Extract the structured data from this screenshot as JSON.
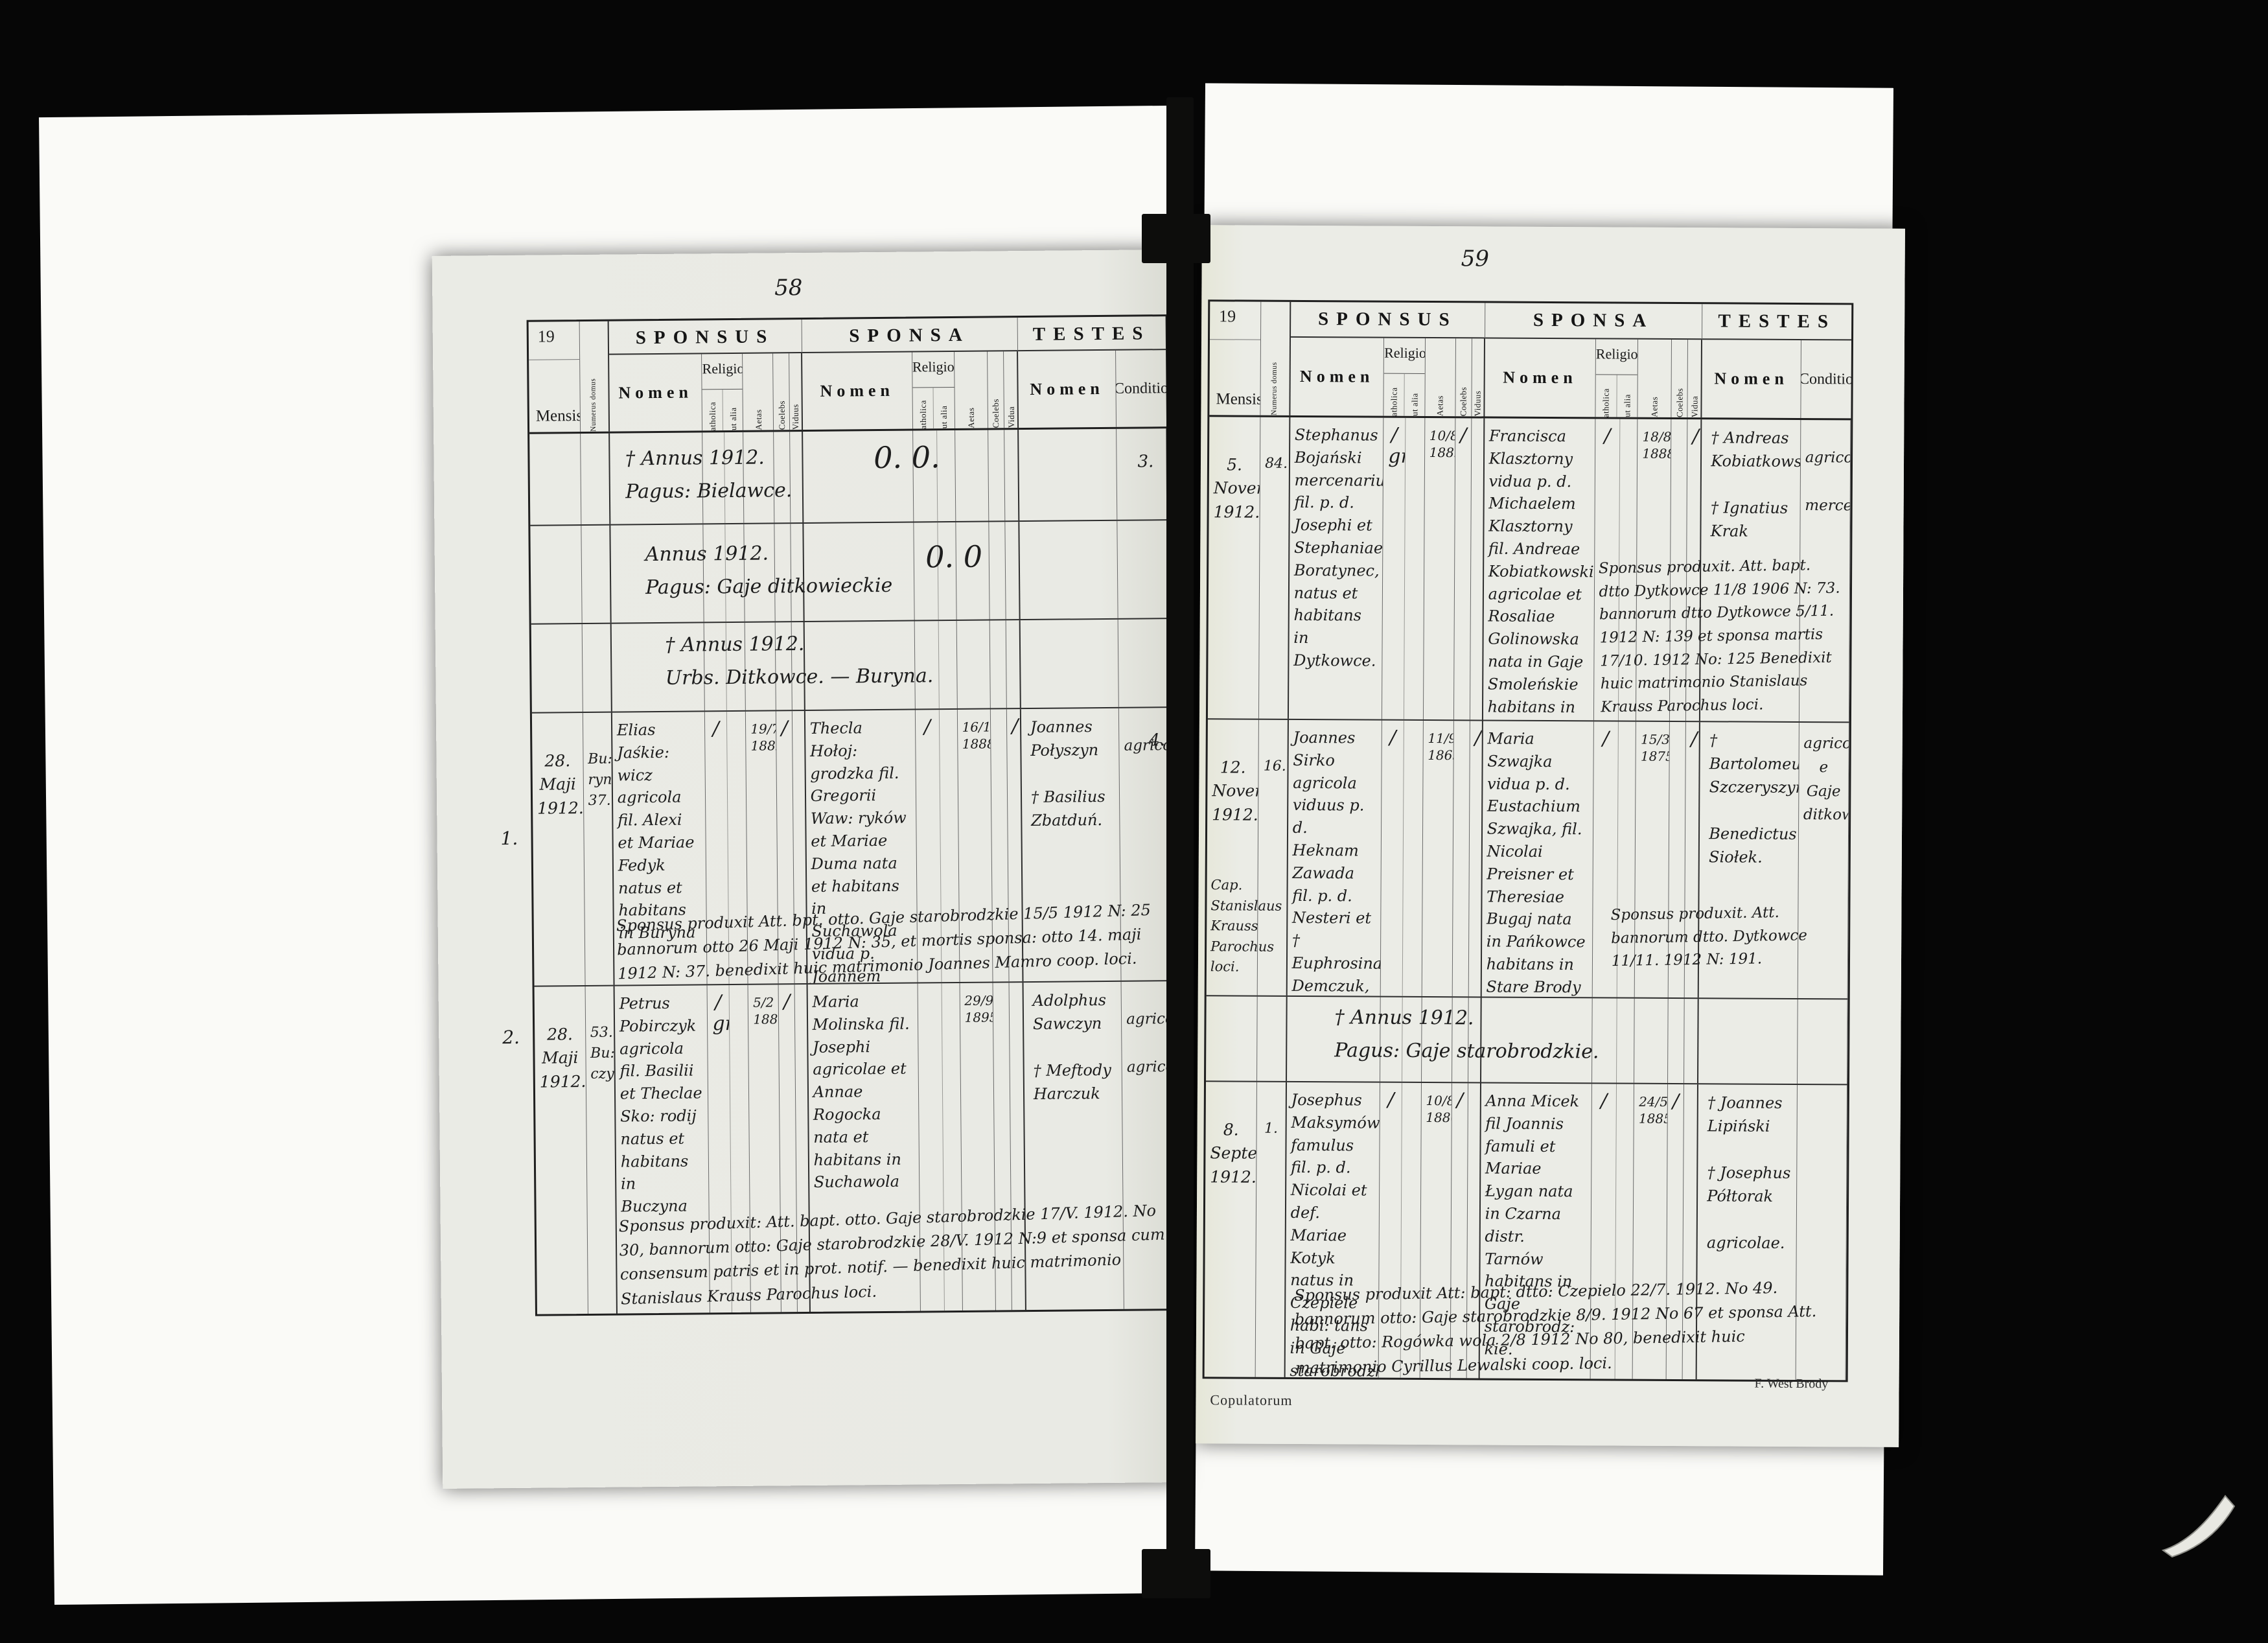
{
  "header": {
    "year_printed": "19",
    "mensis": "Mensis",
    "numerus_domus": "Numerus domus",
    "sponsus": "SPONSUS",
    "sponsa": "SPONSA",
    "testes": "TESTES",
    "nomen": "Nomen",
    "religio": "Religio",
    "catholica": "Catholica",
    "aut_alia": "Aut alia",
    "aetas": "Aetas",
    "coelebs": "Coelebs",
    "viduus": "Viduus",
    "vidua": "Vidua",
    "conditio": "Conditio"
  },
  "left_page": {
    "page_number": "58",
    "margin_marks": {
      "m1": "3.",
      "m2": "4."
    },
    "sections": [
      {
        "text": "† Annus 1912.\nPagus: Bielawce.",
        "mark": "0. 0."
      },
      {
        "text": "Annus 1912.\nPagus: Gaje ditkowieckie",
        "mark": "0. 0"
      },
      {
        "text": "† Annus 1912.\nUrbs. Ditkowce. — Buryna.",
        "mark": ""
      }
    ],
    "records": [
      {
        "ordinal": "1.",
        "mensis": "28.\nMaji\n1912.",
        "numerus": "Bu:\nryna\n37.",
        "sponsus_nomen": "Elias Jaśkie: wicz agricola fil. Alexi et Mariae Fedyk natus et habitans in Buryna",
        "sponsus_catholica": "∕",
        "sponsus_aut_alia": "",
        "sponsus_aetas": "19/7\n1882",
        "sponsus_coelebs": "∕",
        "sponsus_viduus": "",
        "sponsa_nomen": "Thecla Hołoj: grodzka fil. Gregorii Waw: ryków et Mariae Duma nata et habitans in Suchawola vidua p. Joannem Hołojgrodzki.",
        "sponsa_catholica": "∕",
        "sponsa_aut_alia": "",
        "sponsa_aetas": "16/11\n1888",
        "sponsa_coelebs": "",
        "sponsa_vidua": "∕",
        "testes": "Joannes\nPołyszyn\n\n† Basilius\nZbatduń.",
        "conditio": "agricola",
        "note": "Sponsus produxit Att. bpt. otto. Gaje starobrodzkie 15/5 1912 N: 25 bannorum otto 26 Maji 1912 N: 35, et mortis sponsa: otto 14. maji 1912 N: 37. benedixit huic matrimonio Joannes Mamro coop. loci."
      },
      {
        "ordinal": "2.",
        "mensis": "28.\nMaji\n1912.",
        "numerus": "53.\nBu:\nczyna",
        "sponsus_nomen": "Petrus Pobirczyk agricola fil. Basilii et Theclae Sko: rodij natus et habitans in Buczyna",
        "sponsus_catholica": "∕\ngr.",
        "sponsus_aut_alia": "",
        "sponsus_aetas": "5/2\n1885",
        "sponsus_coelebs": "∕",
        "sponsus_viduus": "",
        "sponsa_nomen": "Maria Molinska fil. Josephi agricolae et Annae Rogocka nata et habitans in Suchawola",
        "sponsa_catholica": "",
        "sponsa_aut_alia": "",
        "sponsa_aetas": "29/9\n1895",
        "sponsa_coelebs": "",
        "sponsa_vidua": "",
        "testes": "Adolphus\nSawczyn\n\n† Meftody\nHarczuk",
        "conditio": "agricola\n\nagricola",
        "note": "Sponsus produxit: Att. bapt. otto. Gaje starobrodzkie 17/V. 1912. No 30, bannorum otto: Gaje starobrodzkie 28/V. 1912 N:9 et sponsa cum consensum patris et in prot. notif. — benedixit huic matrimonio Stanislaus Krauss Parochus loci."
      }
    ]
  },
  "right_page": {
    "page_number": "59",
    "sections": [
      {
        "text": "† Annus 1912.\nPagus: Gaje starobrodzkie.",
        "mark": ""
      }
    ],
    "records": [
      {
        "ordinal": "",
        "mensis": "5.\nNovembris\n1912.",
        "officiant": "",
        "numerus": "84.",
        "sponsus_nomen": "Stephanus Bojański mercenarius fil. p. d. Josephi et Stephaniae Boratynec, natus et habitans in Dytkowce.",
        "sponsus_catholica": "∕\ngr.",
        "sponsus_aut_alia": "",
        "sponsus_aetas": "10/8.\n1889.",
        "sponsus_coelebs": "∕",
        "sponsus_viduus": "",
        "sponsa_nomen": "Francisca Klasztorny vidua p. d. Michaelem Klasztorny fil. Andreae Kobiatkowski agricolae et Rosaliae Golinowska nata in Gaje Smoleńskie habitans in Dytkowce",
        "sponsa_catholica": "∕",
        "sponsa_aut_alia": "",
        "sponsa_aetas": "18/8.\n1888",
        "sponsa_coelebs": "",
        "sponsa_vidua": "∕",
        "testes": "† Andreas\nKobiatkowski\n\n† Ignatius\nKrak",
        "conditio": "agricola\n\nmercenarius",
        "note": "Sponsus produxit. Att. bapt. dtto Dytkowce 11/8 1906 N: 73. bannorum dtto Dytkowce 5/11. 1912 N: 139 et sponsa martis 17/10. 1912 No: 125 Benedixit huic matrimonio Stanislaus Krauss Parochus loci."
      },
      {
        "ordinal": "",
        "mensis": "12.\nNovembris\n1912.",
        "officiant": "Cap.\nStanislaus\nKrauss\nParochus loci.",
        "numerus": "16.",
        "sponsus_nomen": "Joannes Sirko agricola viduus p. d. Heknam Zawada fil. p. d. Nesteri et † Euphrosinae Demczuk, natus et habitans in Gaje ditkowieckie",
        "sponsus_catholica": "∕",
        "sponsus_aut_alia": "",
        "sponsus_aetas": "11/9.\n1865",
        "sponsus_coelebs": "",
        "sponsus_viduus": "∕",
        "sponsa_nomen": "Maria Szwajka vidua p. d. Eustachium Szwajka, fil. Nicolai Preisner et Theresiae Bugaj nata in Pańkowce habitans in Stare Brody",
        "sponsa_catholica": "∕",
        "sponsa_aut_alia": "",
        "sponsa_aetas": "15/3.\n1875",
        "sponsa_coelebs": "",
        "sponsa_vidua": "∕",
        "testes": "† Bartolomeus\nSzczeryszyn\n\nBenedictus\nSiołek.",
        "conditio": "agricolae\ne\nGaje\nditkowieckie",
        "note": "Sponsus produxit. Att. bannorum dtto. Dytkowce 11/11. 1912 N: 191."
      },
      {
        "ordinal": "",
        "mensis": "8.\nSeptembris\n1912.",
        "officiant": "",
        "numerus": "1.",
        "sponsus_nomen": "Josephus Maksymów famulus fil. p. d. Nicolai et def. Mariae Kotyk natus in Czepiele habi: tans in Gaje starobrodzkie.",
        "sponsus_catholica": "∕",
        "sponsus_aut_alia": "",
        "sponsus_aetas": "10/8.\n1886",
        "sponsus_coelebs": "∕",
        "sponsus_viduus": "",
        "sponsa_nomen": "Anna Micek fil Joannis famuli et Mariae Łygan nata in Czarna distr. Tarnów habitans in Gaje starobrodz: kie.",
        "sponsa_catholica": "∕",
        "sponsa_aut_alia": "",
        "sponsa_aetas": "24/5.\n1885.",
        "sponsa_coelebs": "∕",
        "sponsa_vidua": "",
        "testes": "† Joannes\nLipiński\n\n† Josephus\nPółtorak\n\nagricolae.",
        "conditio": "",
        "note": "Sponsus produxit Att: bapt: dtto: Czepielo 22/7. 1912. No 49. bannorum otto: Gaje starobrodzkie 8/9. 1912 No 67 et sponsa Att. bapt. otto: Rogówka wola 2/8 1912 No 80, benedixit huic matrimonio Cyrillus Lewalski coop. loci."
      }
    ]
  },
  "footer": {
    "copulatorum": "Copulatorum",
    "printer": "F. West Brody"
  }
}
